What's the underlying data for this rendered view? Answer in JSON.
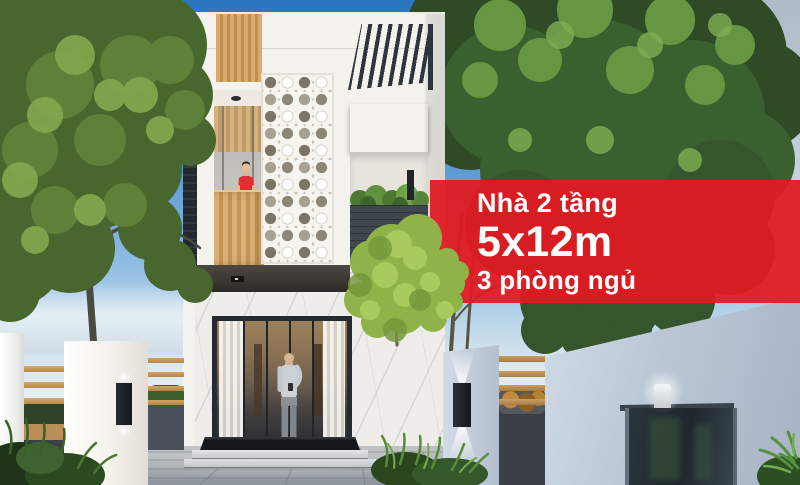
{
  "banner": {
    "line1": "Nhà 2 tầng",
    "line2": "5x12m",
    "line3": "3 phòng ngủ",
    "background_color": "rgba(225,26,34,0.94)",
    "text_color": "#ffffff"
  }
}
